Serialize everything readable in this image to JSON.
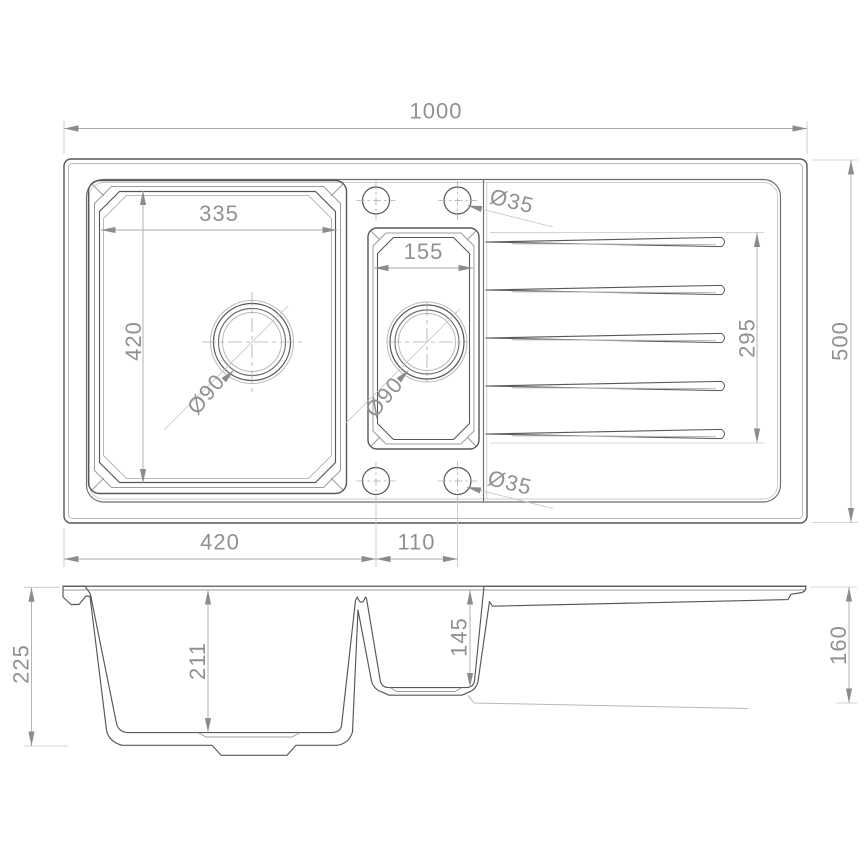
{
  "views": {
    "plan": {
      "overall_width": "1000",
      "overall_depth": "500",
      "main_bowl": {
        "width": "335",
        "length": "420",
        "drain": "Ø90"
      },
      "small_bowl": {
        "width": "155",
        "drain": "Ø90"
      },
      "drainer_length": "295",
      "tap_hole_top": "Ø35",
      "tap_hole_bottom": "Ø35",
      "offset_main": "420",
      "offset_small": "110"
    },
    "section": {
      "overall_height": "225",
      "main_bowl_depth": "211",
      "small_bowl_depth": "145",
      "end_height": "160"
    }
  }
}
